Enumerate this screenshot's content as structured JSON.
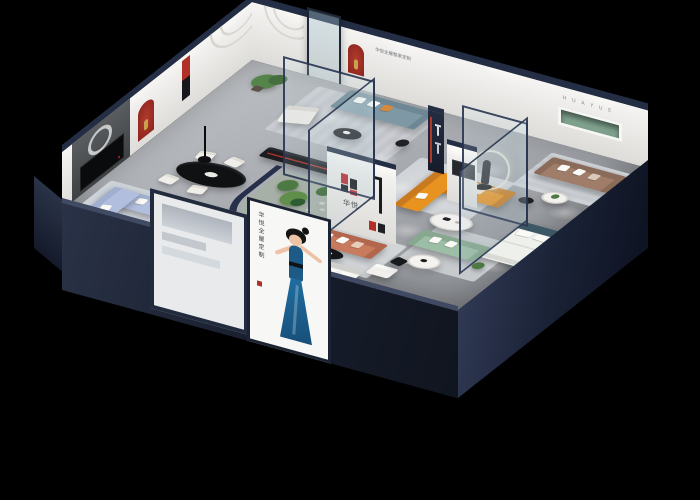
{
  "scene": {
    "description": "Isometric cutaway 3D render of a furniture showroom apartment on a black background, with staged living rooms, dining area, kitchen, glass atrium with plants, bedrooms and brand display walls",
    "background": "#000000",
    "style": "dollhouse axonometric render"
  },
  "brand": {
    "logo_text": "华悦",
    "logo_mark_red": "#c0282d",
    "logo_mark_black": "#17171a",
    "wall_letters": "H U A Y U E",
    "slogan": "华悦全屋整家定制"
  },
  "poster": {
    "vertical_text": "华悦全屋定制",
    "figure": "woman-in-blue-dress"
  },
  "palette": {
    "wall_navy": "#232d44",
    "wall_white": "#f4f3f1",
    "floor_grey": "#a8abb0",
    "accent_red": "#b03028",
    "sofa_orange": "#e8921f",
    "sofa_teal": "#7e99a5",
    "sofa_brown": "#a07d69",
    "sofa_periwinkle": "#b2bedd",
    "sofa_terracotta": "#c97b5d",
    "sofa_green": "#9cbda6",
    "bed_teal": "#3c5864",
    "glass_tint": "rgba(205,225,230,0.18)"
  },
  "rooms": [
    {
      "name": "entry-lounge",
      "items": [
        "teal sofa",
        "white armchair",
        "black round coffee table",
        "media credenza",
        "potted tree",
        "glass entry door"
      ]
    },
    {
      "name": "dining-area",
      "items": [
        "black oval table",
        "four white chairs",
        "black pendant lamp"
      ]
    },
    {
      "name": "periwinkle-living",
      "items": [
        "periwinkle sectional sofa",
        "black tv console",
        "dark feature wall with ring art"
      ]
    },
    {
      "name": "kitchen",
      "items": [
        "white counter",
        "black appliance unit",
        "grey ottoman"
      ]
    },
    {
      "name": "glass-atrium",
      "items": [
        "curved navy wall",
        "full-height glass panels",
        "cacti planting"
      ]
    },
    {
      "name": "orange-showroom",
      "items": [
        "orange l-shaped sofa",
        "white oval coffee table",
        "sculpture with glowing halo ring"
      ]
    },
    {
      "name": "brand-display",
      "items": [
        "logo wall",
        "terracotta sofa",
        "black oval coffee table",
        "white ottoman",
        "grey platform bed"
      ]
    },
    {
      "name": "right-lounge",
      "items": [
        "brown sofa",
        "round side tables",
        "green recessed display niche",
        "red arched niches"
      ]
    },
    {
      "name": "green-lounge",
      "items": [
        "sage green sofa",
        "round white table",
        "black chair",
        "plant"
      ]
    },
    {
      "name": "glass-bedroom",
      "items": [
        "teal upholstered bed with white bedding",
        "glass partition corner"
      ]
    }
  ]
}
